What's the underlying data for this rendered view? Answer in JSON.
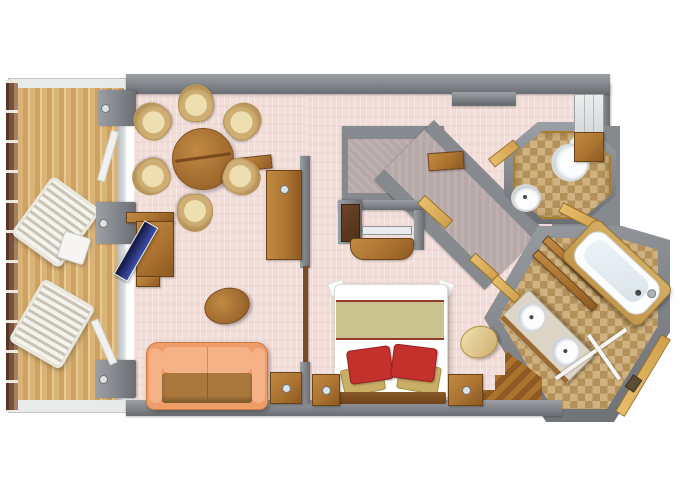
{
  "floorplan": {
    "kind": "cruise-suite-top-down-3d-floor-plan",
    "rooms": [
      {
        "name": "balcony",
        "floor": "teak-deck",
        "items": [
          "railing",
          "lounge-chair",
          "lounge-chair",
          "side-table",
          "sliding-glass-doors"
        ]
      },
      {
        "name": "living-room",
        "floor": "pink-carpet",
        "items": [
          "round-dining-table",
          "dining-chair",
          "dining-chair",
          "dining-chair",
          "dining-chair",
          "dining-chair",
          "dining-chair",
          "sideboard-cabinet",
          "writing-desk",
          "desk-chair-navy",
          "oval-coffee-table",
          "sofa",
          "minibar-cabinet"
        ]
      },
      {
        "name": "bedroom",
        "floor": "pink-carpet",
        "items": [
          "double-bed",
          "red-pillow",
          "red-pillow",
          "tan-pillow",
          "tan-pillow",
          "nightstand",
          "nightstand",
          "tv-cabinet",
          "round-ottoman"
        ]
      },
      {
        "name": "walk-in-closet",
        "floor": "carpet",
        "items": [
          "wardrobe-corridor",
          "door-threshold"
        ]
      },
      {
        "name": "entry-hall",
        "floor": "pink-carpet",
        "items": [
          "entry-door-recess",
          "wardrobe",
          "console"
        ]
      },
      {
        "name": "water-closet",
        "floor": "beige-tile",
        "items": [
          "toilet",
          "round-washbasin",
          "door-threshold"
        ]
      },
      {
        "name": "bathroom",
        "floor": "beige-tile",
        "items": [
          "bathtub",
          "tub-deck-steps",
          "double-sink-vanity",
          "shower-glass-partition",
          "floor-drain",
          "wood-threshold-steps"
        ]
      }
    ]
  },
  "colors": {
    "wall": "#868a8f",
    "wallD": "#6a6e72",
    "wallL": "#9ba0a5",
    "pink": "#f3ddd8",
    "deck1": "#dab377",
    "deck2": "#cda263",
    "deck3": "#e8cb92",
    "rail": "#7d503c",
    "tile1": "#c7a368",
    "carpet": "#b7a9a8",
    "wood": "#ab7230",
    "woodL": "#c08a42",
    "woodD": "#8c5a22",
    "woodDeep": "#6d431a",
    "cream": "#eddfb0",
    "creamD": "#cfae74",
    "sofa": "#ee9d68",
    "sofaL": "#f5b287",
    "sofaSeat": "#aa783c",
    "bedBand": "#cac28f",
    "pillowRed": "#c4302c",
    "pillowTan": "#c9ae66",
    "navy": "#27306e",
    "gold": "#d2a14e",
    "marble": "#ddd5c6",
    "silver": "#dce1e3",
    "fixtureWhite": "#fbfdfe"
  }
}
